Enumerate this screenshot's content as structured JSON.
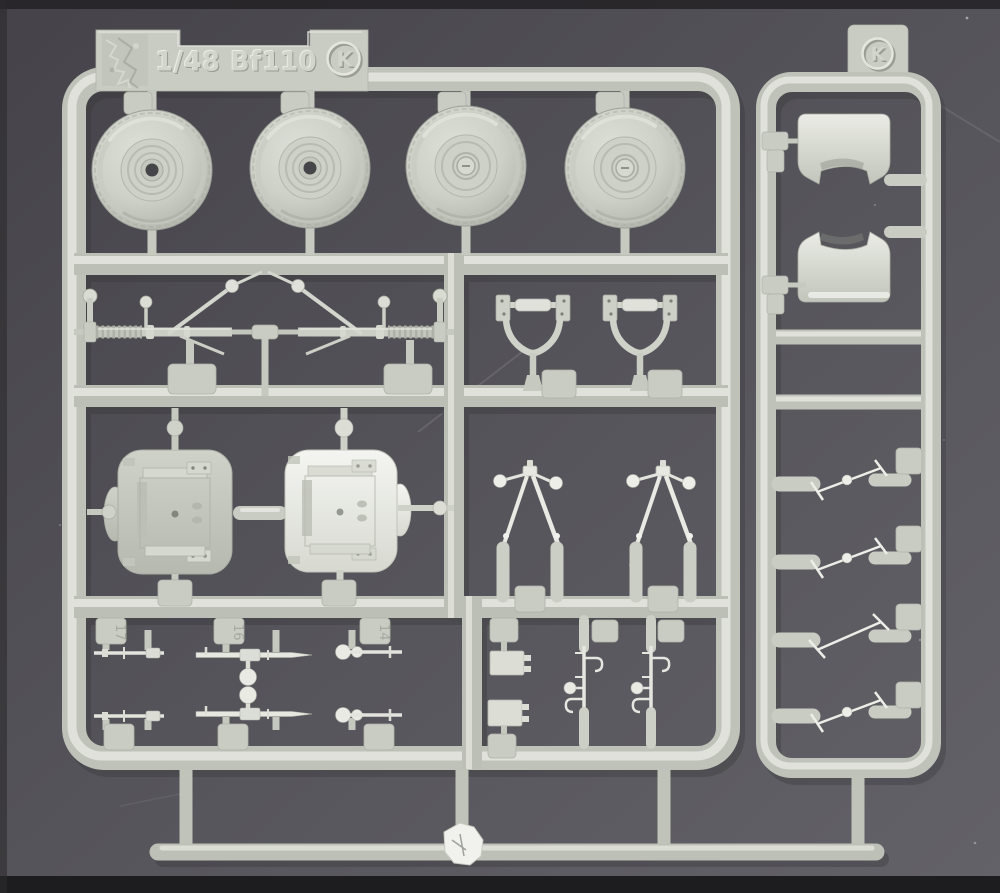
{
  "image": {
    "description": "Photograph of a light grey injection-moulded plastic model-kit sprue (parts tree) lying on a dark grey surface",
    "background_color": "#55545a",
    "plastic_base_color": "#c6c9c0",
    "plastic_highlight_color": "#e8eae3",
    "plastic_shadow_color": "#999c93"
  },
  "main_sprue": {
    "label": {
      "text": "1/48 Bf110",
      "mold_letter": "K"
    },
    "part_pads": {
      "pad_a": "17",
      "pad_b": "16",
      "pad_c": "14"
    },
    "sections": [
      "four main wheel halves",
      "two landing gear oleo struts",
      "two fork yokes",
      "two wheel-bay bulkhead plates",
      "two V retraction struts",
      "six small gun and rod parts in two rows",
      "two equipment boxes and two hooked sight rods"
    ]
  },
  "side_sprue": {
    "mold_letter": "K",
    "sections": [
      "two engine cowling intake halves",
      "four thin actuator rod parts"
    ]
  },
  "parts": [
    {
      "name": "main-wheel-half-inner",
      "qty": 2
    },
    {
      "name": "main-wheel-half-outer",
      "qty": 2
    },
    {
      "name": "landing-gear-oleo-strut",
      "qty": 2
    },
    {
      "name": "fork-yoke",
      "qty": 2
    },
    {
      "name": "wheel-bay-bulkhead-plate",
      "qty": 2
    },
    {
      "name": "gear-retraction-v-strut",
      "qty": 2
    },
    {
      "name": "machine-gun",
      "qty": 2
    },
    {
      "name": "thin-rod",
      "qty": 2
    },
    {
      "name": "knob-rod",
      "qty": 2
    },
    {
      "name": "equipment-box",
      "qty": 2
    },
    {
      "name": "hooked-sight-rod",
      "qty": 2
    },
    {
      "name": "engine-cowling-intake-half",
      "qty": 2
    },
    {
      "name": "actuator-rod",
      "qty": 4
    }
  ]
}
